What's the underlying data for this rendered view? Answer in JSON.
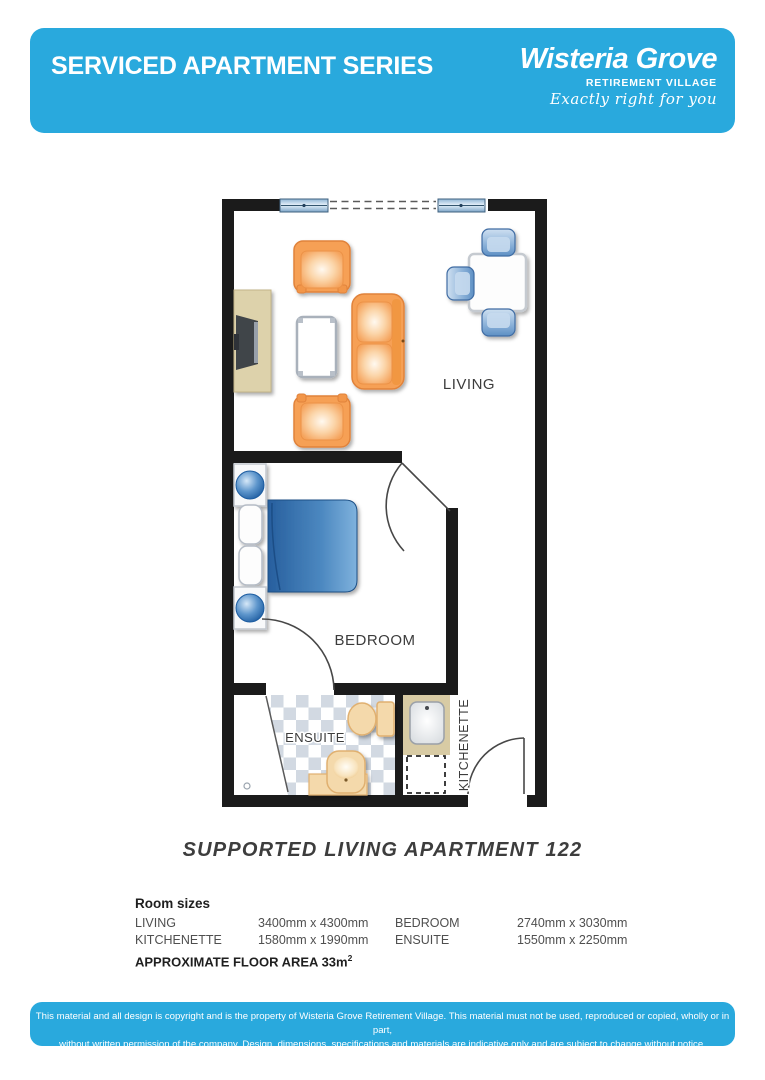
{
  "header": {
    "title": "SERVICED APARTMENT SERIES",
    "brand": {
      "name": "Wisteria Grove",
      "subtitle": "RETIREMENT VILLAGE",
      "tagline": "Exactly right for you"
    },
    "accent_color": "#29a9dd"
  },
  "floorplan": {
    "rooms": {
      "living": "LIVING",
      "bedroom": "BEDROOM",
      "ensuite": "ENSUITE",
      "kitchenette": "KITCHENETTE"
    }
  },
  "plan_title": "SUPPORTED LIVING APARTMENT 122",
  "room_sizes": {
    "heading": "Room sizes",
    "rows": [
      {
        "label": "LIVING",
        "size": "3400mm x 4300mm",
        "label2": "BEDROOM",
        "size2": "2740mm x 3030mm"
      },
      {
        "label": "KITCHENETTE",
        "size": "1580mm x 1990mm",
        "label2": "ENSUITE",
        "size2": "1550mm x 2250mm"
      }
    ],
    "floor_area_label": "APPROXIMATE FLOOR AREA 33m",
    "floor_area_sup": "2"
  },
  "footer": {
    "line1": "This material and all design is copyright and is the property of Wisteria Grove Retirement Village. This material must not be used, reproduced or copied, wholly or in part,",
    "line2": "without written permission of the company. Design, dimensions, specifications and materials are indicative only and are subject to change without notice."
  }
}
